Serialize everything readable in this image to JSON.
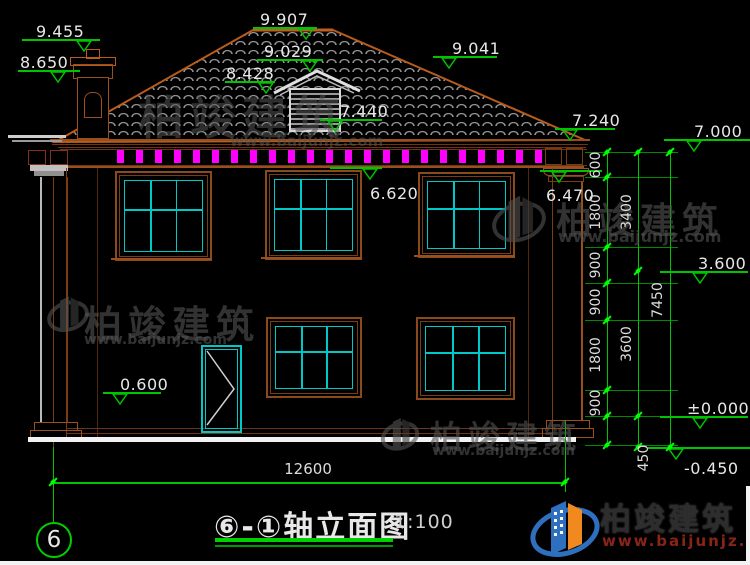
{
  "drawing": {
    "title": "⑥-①轴立面图",
    "scale": "1:100",
    "axis_bubble": "6",
    "bottom_dim": "12600"
  },
  "brand": {
    "name": "柏竣建筑",
    "url": "www.baijunjz.com",
    "url_color": "#8a2418",
    "name_color": "#2d2d2d"
  },
  "colors": {
    "dim_green": "#00c400",
    "bright_green": "#00ff00",
    "frame_brown": "#9a4f1d",
    "mullion_cyan": "#00c8c8",
    "dentil_magenta": "#ff00ff",
    "text_white": "#e8e8e8",
    "ground_white": "#f2f2f2",
    "logo_blue": "#2f6fc0",
    "logo_orange": "#f08a1e"
  },
  "elevation_marks": [
    {
      "label": "9.455",
      "lx": 22,
      "lw": 78,
      "ly": 39,
      "tx": 76,
      "text_x": 36,
      "text_y": 22,
      "side": "above"
    },
    {
      "label": "8.650",
      "lx": 18,
      "lw": 62,
      "ly": 70,
      "tx": 50,
      "text_x": 20,
      "text_y": 53,
      "side": "above"
    },
    {
      "label": "9.907",
      "lx": 253,
      "lw": 64,
      "ly": 27,
      "tx": 298,
      "text_x": 260,
      "text_y": 10,
      "side": "above"
    },
    {
      "label": "9.029",
      "lx": 257,
      "lw": 66,
      "ly": 59,
      "tx": 302,
      "text_x": 264,
      "text_y": 42,
      "side": "above"
    },
    {
      "label": "8.428",
      "lx": 225,
      "lw": 50,
      "ly": 81,
      "tx": 258,
      "text_x": 226,
      "text_y": 64,
      "side": "above"
    },
    {
      "label": "7.440",
      "lx": 320,
      "lw": 62,
      "ly": 119,
      "tx": 327,
      "text_x": 340,
      "text_y": 102,
      "side": "above"
    },
    {
      "label": "9.041",
      "lx": 433,
      "lw": 64,
      "ly": 56,
      "tx": 441,
      "text_x": 452,
      "text_y": 39,
      "side": "above"
    },
    {
      "label": "7.240",
      "lx": 555,
      "lw": 60,
      "ly": 128,
      "tx": 562,
      "text_x": 572,
      "text_y": 111,
      "side": "above"
    },
    {
      "label": "7.000",
      "lx": 664,
      "lw": 86,
      "ly": 139,
      "tx": 686,
      "text_x": 694,
      "text_y": 122,
      "side": "above"
    },
    {
      "label": "6.620",
      "lx": 330,
      "lw": 52,
      "ly": 167,
      "tx": 362,
      "text_x": 370,
      "text_y": 184,
      "side": "below"
    },
    {
      "label": "6.470",
      "lx": 540,
      "lw": 62,
      "ly": 170,
      "tx": 551,
      "text_x": 546,
      "text_y": 186,
      "side": "below"
    },
    {
      "label": "0.600",
      "lx": 103,
      "lw": 58,
      "ly": 392,
      "tx": 112,
      "text_x": 120,
      "text_y": 375,
      "side": "above"
    },
    {
      "label": "3.600",
      "lx": 660,
      "lw": 88,
      "ly": 271,
      "tx": 692,
      "text_x": 698,
      "text_y": 254,
      "side": "above"
    },
    {
      "label": "±0.000",
      "lx": 660,
      "lw": 88,
      "ly": 416,
      "tx": 692,
      "text_x": 687,
      "text_y": 399,
      "side": "above"
    },
    {
      "label": "-0.450",
      "lx": 648,
      "lw": 102,
      "ly": 447,
      "tx": 668,
      "text_x": 684,
      "text_y": 459,
      "side": "below"
    }
  ],
  "vertical_chains": [
    {
      "x": 607,
      "label_x": 596,
      "segments": [
        {
          "y1": 152,
          "y2": 177,
          "label": "600"
        },
        {
          "y1": 177,
          "y2": 247,
          "label": "1800"
        },
        {
          "y1": 247,
          "y2": 283,
          "label": "900"
        },
        {
          "y1": 283,
          "y2": 320,
          "label": "900"
        },
        {
          "y1": 320,
          "y2": 390,
          "label": "1800"
        },
        {
          "y1": 390,
          "y2": 416,
          "label": "900"
        },
        {
          "y1": 416,
          "y2": 445,
          "label": ""
        }
      ]
    },
    {
      "x": 638,
      "label_x": 627,
      "segments": [
        {
          "y1": 152,
          "y2": 271,
          "label": "3400"
        },
        {
          "y1": 271,
          "y2": 416,
          "label": "3600"
        },
        {
          "y1": 416,
          "y2": 447,
          "label": "450",
          "label_x": 644,
          "label_y": 458
        }
      ]
    },
    {
      "x": 670,
      "label_x": 658,
      "segments": [
        {
          "y1": 152,
          "y2": 447,
          "label": "7450"
        }
      ]
    }
  ],
  "extension_levels": [
    152,
    177,
    247,
    283,
    320,
    390,
    416,
    445
  ],
  "bottom_dimension": {
    "y": 482,
    "x1": 53,
    "x2": 565,
    "label_x": 308,
    "label_y": 469
  },
  "eave": {
    "dentils": {
      "x_start": 117,
      "x_end": 537,
      "step": 19,
      "w": 7,
      "h": 13,
      "y": 150
    }
  },
  "windows": [
    {
      "x": 115,
      "y": 171,
      "w": 93,
      "h": 86
    },
    {
      "x": 265,
      "y": 170,
      "w": 93,
      "h": 86
    },
    {
      "x": 418,
      "y": 172,
      "w": 93,
      "h": 82
    },
    {
      "x": 266,
      "y": 317,
      "w": 92,
      "h": 77
    },
    {
      "x": 416,
      "y": 317,
      "w": 95,
      "h": 79
    }
  ],
  "sills": [
    {
      "x": 111,
      "y": 258,
      "w": 101
    },
    {
      "x": 261,
      "y": 257,
      "w": 101
    },
    {
      "x": 414,
      "y": 255,
      "w": 101
    }
  ],
  "door": {
    "x": 201,
    "y": 345,
    "w": 37,
    "h": 84
  },
  "watermarks": [
    {
      "x": 138,
      "y": 82,
      "zh_size": 46,
      "url_x": 230,
      "url_y": 132,
      "url_size": 15,
      "opacity": 0.55,
      "icon": false
    },
    {
      "x": 556,
      "y": 192,
      "zh_size": 36,
      "url_x": 558,
      "url_y": 227,
      "url_size": 16,
      "opacity": 0.6,
      "icon": true,
      "icon_x": 490,
      "icon_y": 190,
      "icon_s": 58
    },
    {
      "x": 84,
      "y": 294,
      "zh_size": 38,
      "url_x": 84,
      "url_y": 332,
      "url_size": 14,
      "opacity": 0.6,
      "icon": true,
      "icon_x": 46,
      "icon_y": 292,
      "icon_s": 44
    },
    {
      "x": 430,
      "y": 412,
      "zh_size": 32,
      "url_x": 432,
      "url_y": 443,
      "url_size": 14,
      "opacity": 0.6,
      "icon": true,
      "icon_x": 380,
      "icon_y": 414,
      "icon_s": 40
    }
  ]
}
